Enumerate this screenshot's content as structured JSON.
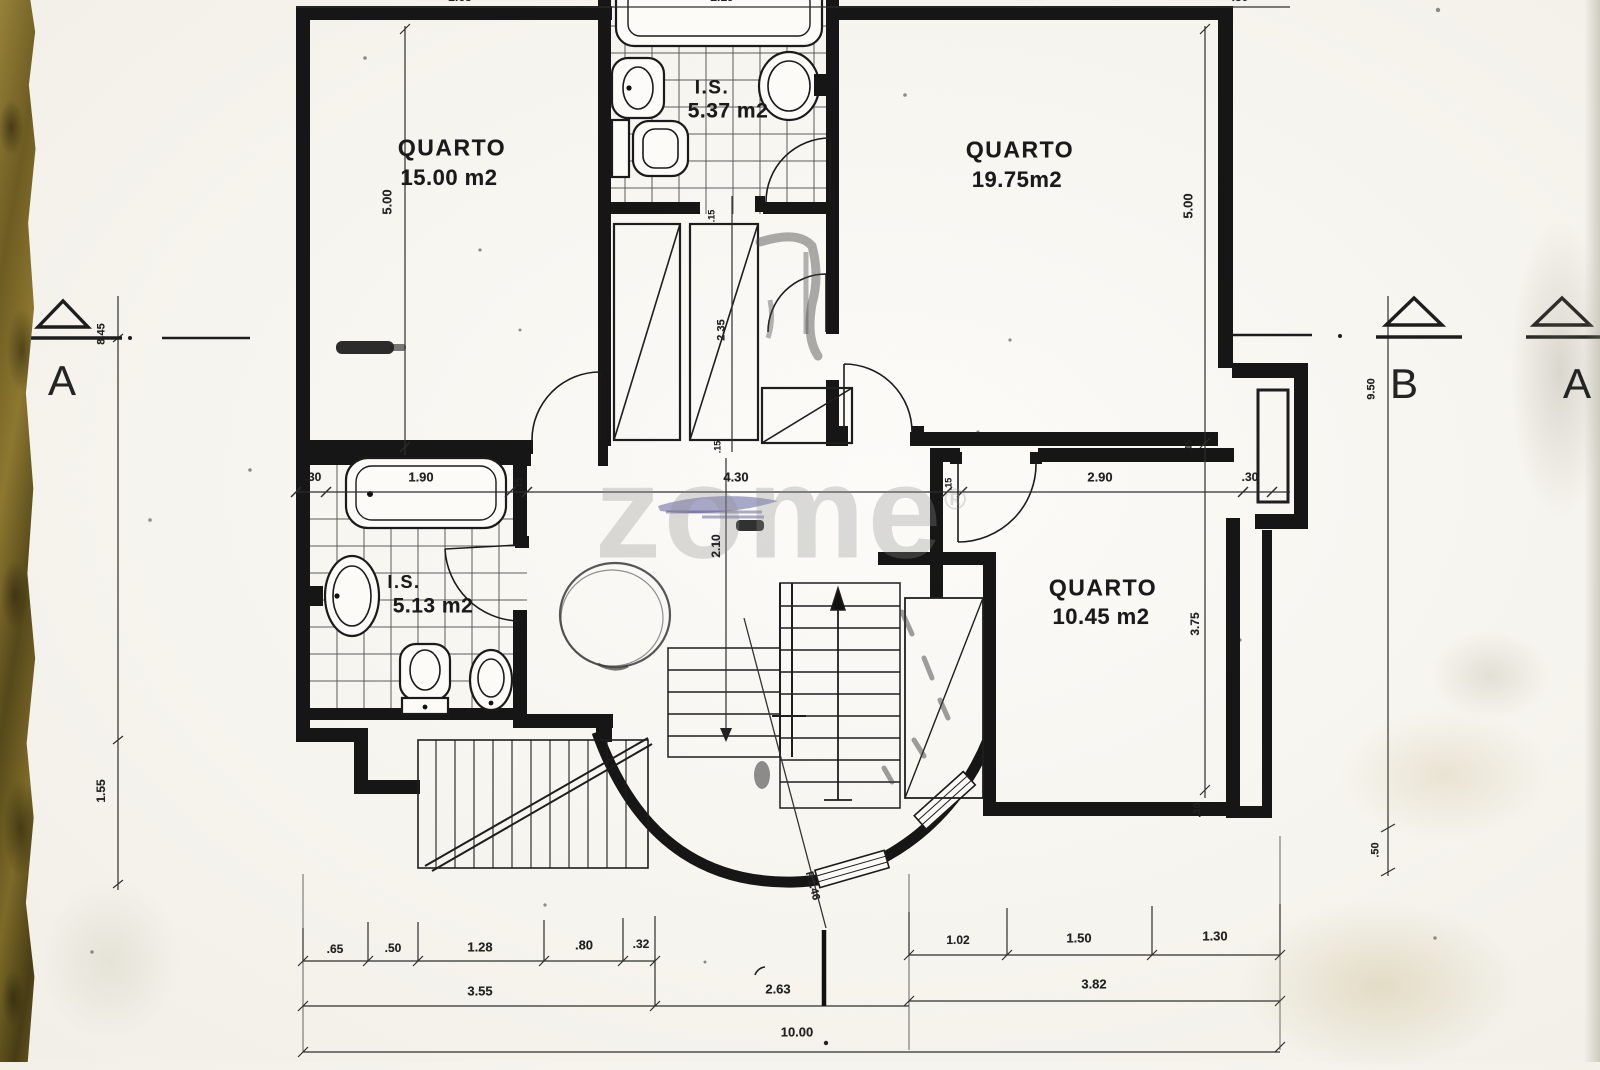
{
  "watermark": {
    "text": "zome",
    "reg": "®"
  },
  "rooms": {
    "q1": {
      "name": "QUARTO",
      "area": "15.00 m2"
    },
    "is1": {
      "name": "I.S.",
      "area": "5.37 m2"
    },
    "q2": {
      "name": "QUARTO",
      "area": "19.75m2"
    },
    "is2": {
      "name": "I.S.",
      "area": "5.13 m2"
    },
    "q3": {
      "name": "QUARTO",
      "area": "10.45 m2"
    }
  },
  "markers": {
    "a_left": "A",
    "b_right": "B",
    "a_far_right": "A"
  },
  "dims": {
    "v500l": "5.00",
    "v500r": "5.00",
    "v845": "8.45",
    "v950": "9.50",
    "v235": "2.35",
    "v210": "2.10",
    "v375": "3.75",
    "v155": "1.55",
    "v30r": ".30",
    "v50r": ".50",
    "r146": "R1.46",
    "t15a": ".15",
    "t15b": ".15",
    "t15c": ".15",
    "t15d": ".15",
    "t15e": ".15",
    "h30a": ".30",
    "h190": "1.90",
    "h430": "4.30",
    "h290": "2.90",
    "h30b": ".30",
    "c65": ".65",
    "c50": ".50",
    "c128": "1.28",
    "c80": ".80",
    "c32": ".32",
    "c355": "3.55",
    "c263": "2.63",
    "c102": "1.02",
    "c150": "1.50",
    "c130": "1.30",
    "c382": "3.82",
    "c1000": "10.00",
    "top1": "2.65",
    "top2": "2.19",
    "top3": "3.93",
    "top4": ".50"
  }
}
